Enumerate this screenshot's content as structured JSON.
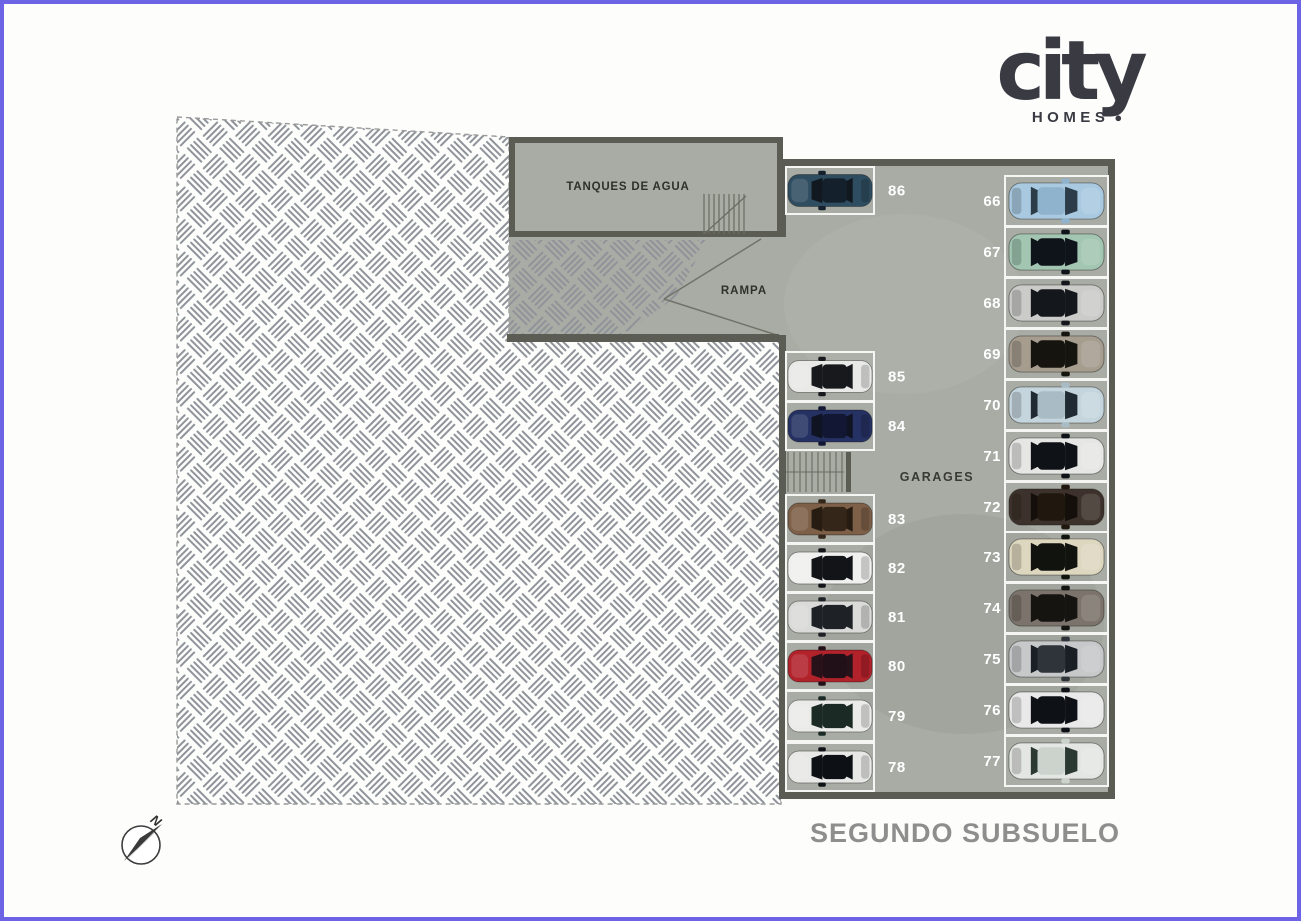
{
  "brand": {
    "name": "city",
    "sub": "HOMES",
    "dot": "●"
  },
  "plan": {
    "room_label": "TANQUES DE AGUA",
    "ramp_label": "RAMPA",
    "garage_label": "GARAGES",
    "floor_title": "SEGUNDO SUBSUELO",
    "compass_north": "N"
  },
  "colors": {
    "frame": "#6c64e4",
    "concrete": "#a9aca4",
    "wall": "#5b5c54",
    "white_line": "#f5f5f3",
    "hatch": "#8f939a",
    "dash": "#9a9a9a",
    "number_white": "#ffffff",
    "title_gray": "#8e8e8e",
    "label_dark": "#30302b",
    "logo_dark": "#3a3a43"
  },
  "spots": {
    "left": [
      {
        "number": "86",
        "body": "#2f4d60",
        "glass": "#111820",
        "roof": "#14202b"
      },
      {
        "number": "85",
        "body": "#e9e9e7",
        "glass": "#17191d",
        "roof": "#17191d"
      },
      {
        "number": "84",
        "body": "#253162",
        "glass": "#0f1322",
        "roof": "#121833"
      },
      {
        "number": "83",
        "body": "#7e6048",
        "glass": "#261c12",
        "roof": "#342619"
      },
      {
        "number": "82",
        "body": "#f0f0ee",
        "glass": "#121418",
        "roof": "#121418"
      },
      {
        "number": "81",
        "body": "#dadad8",
        "glass": "#1e2227",
        "roof": "#1e2227"
      },
      {
        "number": "80",
        "body": "#b2222b",
        "glass": "#27121a",
        "roof": "#221019"
      },
      {
        "number": "79",
        "body": "#ebebe9",
        "glass": "#1b2a24",
        "roof": "#1b2a24"
      },
      {
        "number": "78",
        "body": "#e8e8e6",
        "glass": "#0d1115",
        "roof": "#0d1115"
      }
    ],
    "right": [
      {
        "number": "66",
        "body": "#a9c9e1",
        "glass": "#2c3c49",
        "roof": "#8fb3cd"
      },
      {
        "number": "67",
        "body": "#a2c6b1",
        "glass": "#0f141a",
        "roof": "#0f141a"
      },
      {
        "number": "68",
        "body": "#cbcbc9",
        "glass": "#14171b",
        "roof": "#14171b"
      },
      {
        "number": "69",
        "body": "#a69d8f",
        "glass": "#15140e",
        "roof": "#15140e"
      },
      {
        "number": "70",
        "body": "#c5d5dd",
        "glass": "#202a32",
        "roof": "#a9bcc6"
      },
      {
        "number": "71",
        "body": "#e6e6e4",
        "glass": "#0f1317",
        "roof": "#0f1317"
      },
      {
        "number": "72",
        "body": "#3d322b",
        "glass": "#140f0b",
        "roof": "#20180f"
      },
      {
        "number": "73",
        "body": "#ded7c0",
        "glass": "#11130e",
        "roof": "#11130e"
      },
      {
        "number": "74",
        "body": "#7c746c",
        "glass": "#151410",
        "roof": "#151410"
      },
      {
        "number": "75",
        "body": "#c6c8ca",
        "glass": "#191f25",
        "roof": "#2e343a"
      },
      {
        "number": "76",
        "body": "#e9e9e9",
        "glass": "#0e1217",
        "roof": "#0e1217"
      },
      {
        "number": "77",
        "body": "#e4e6e3",
        "glass": "#2b3932",
        "roof": "#ccd3cd"
      }
    ]
  }
}
